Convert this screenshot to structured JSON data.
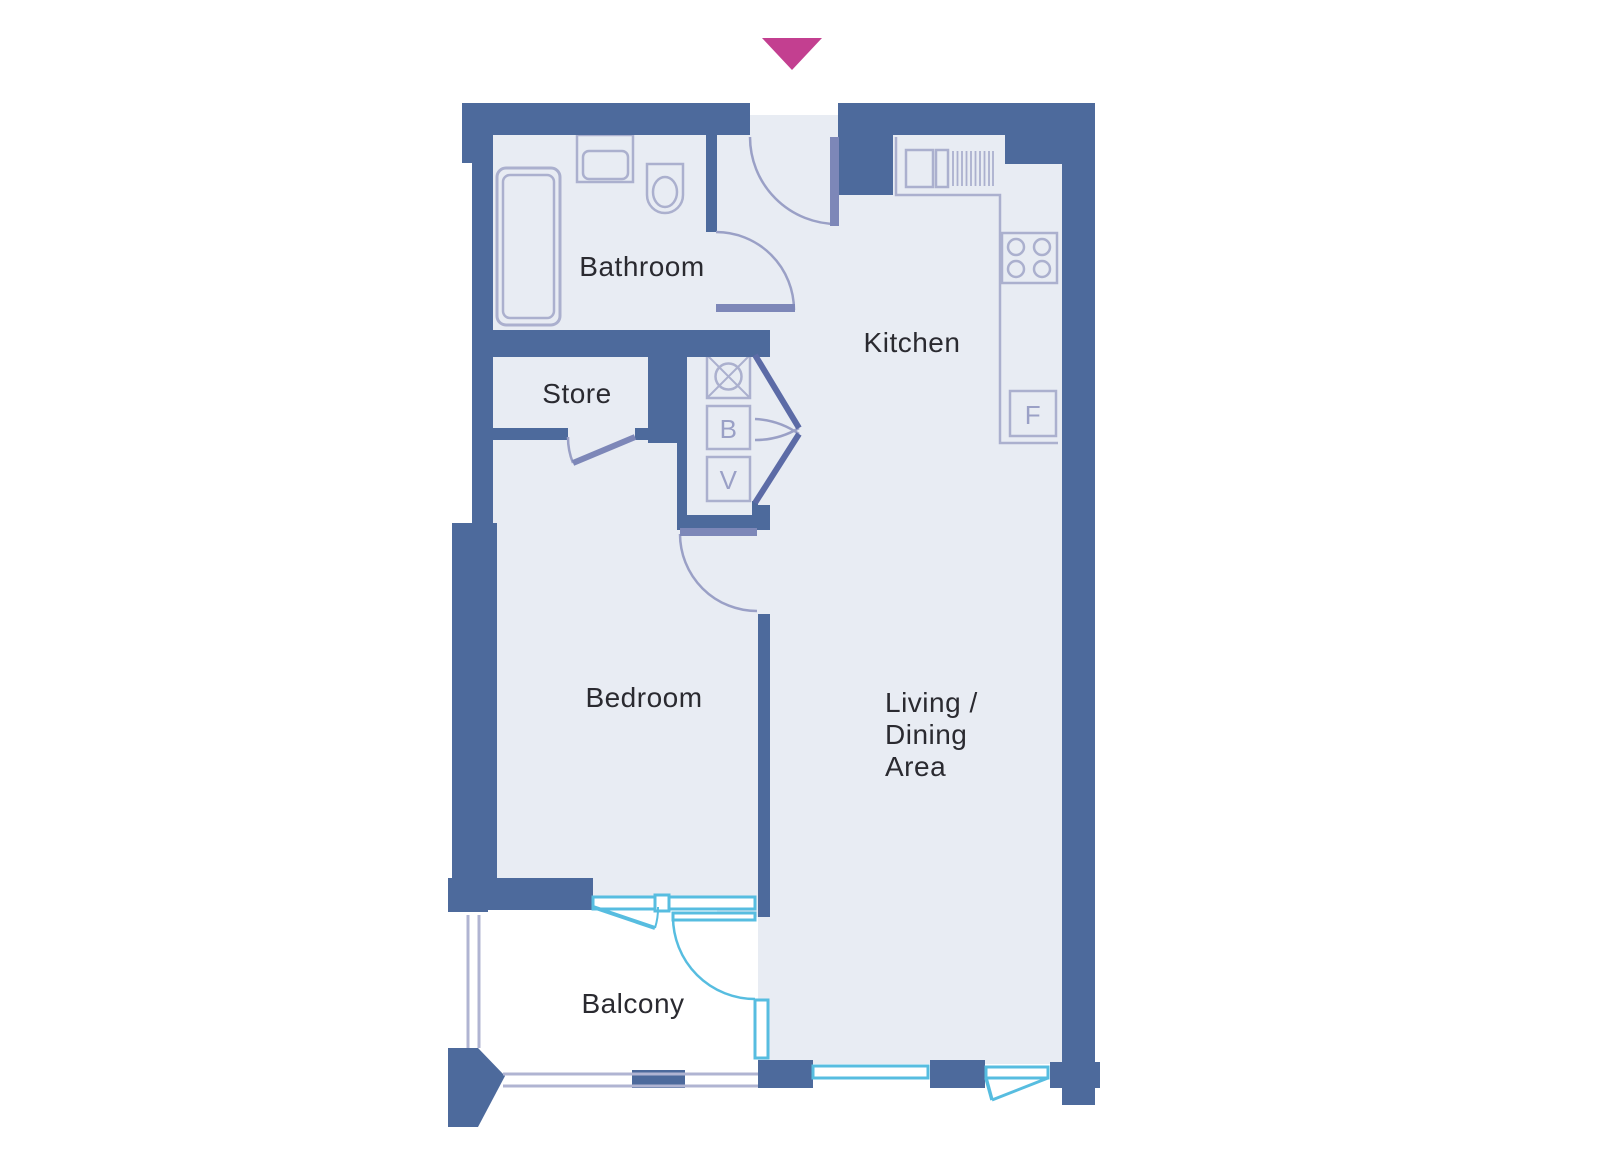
{
  "plan": {
    "title": "apartment-floor-plan",
    "colors": {
      "wall": "#4d6a9c",
      "floor": "#e8ecf3",
      "fixture_outline": "#abb0ce",
      "door_leaf": "#7d87b8",
      "door_arc": "#9aa0c6",
      "window_glazing": "#57bde0",
      "balcony_rail": "#b0b4d2",
      "entrance_marker": "#c33f90",
      "label_text": "#2a2a30"
    },
    "rooms": {
      "bathroom": {
        "label": "Bathroom"
      },
      "kitchen": {
        "label": "Kitchen"
      },
      "store": {
        "label": "Store"
      },
      "bedroom": {
        "label": "Bedroom"
      },
      "living": {
        "lines": [
          "Living /",
          "Dining",
          "Area"
        ]
      },
      "balcony": {
        "label": "Balcony"
      }
    },
    "appliances": {
      "boiler": "B",
      "ventilation": "V",
      "fridge": "F"
    },
    "icons": [
      "entrance-arrow-icon",
      "bathtub-icon",
      "basin-icon",
      "toilet-icon",
      "kitchen-sink-icon",
      "drainer-icon",
      "hob-icon",
      "washer-symbol-icon"
    ]
  }
}
